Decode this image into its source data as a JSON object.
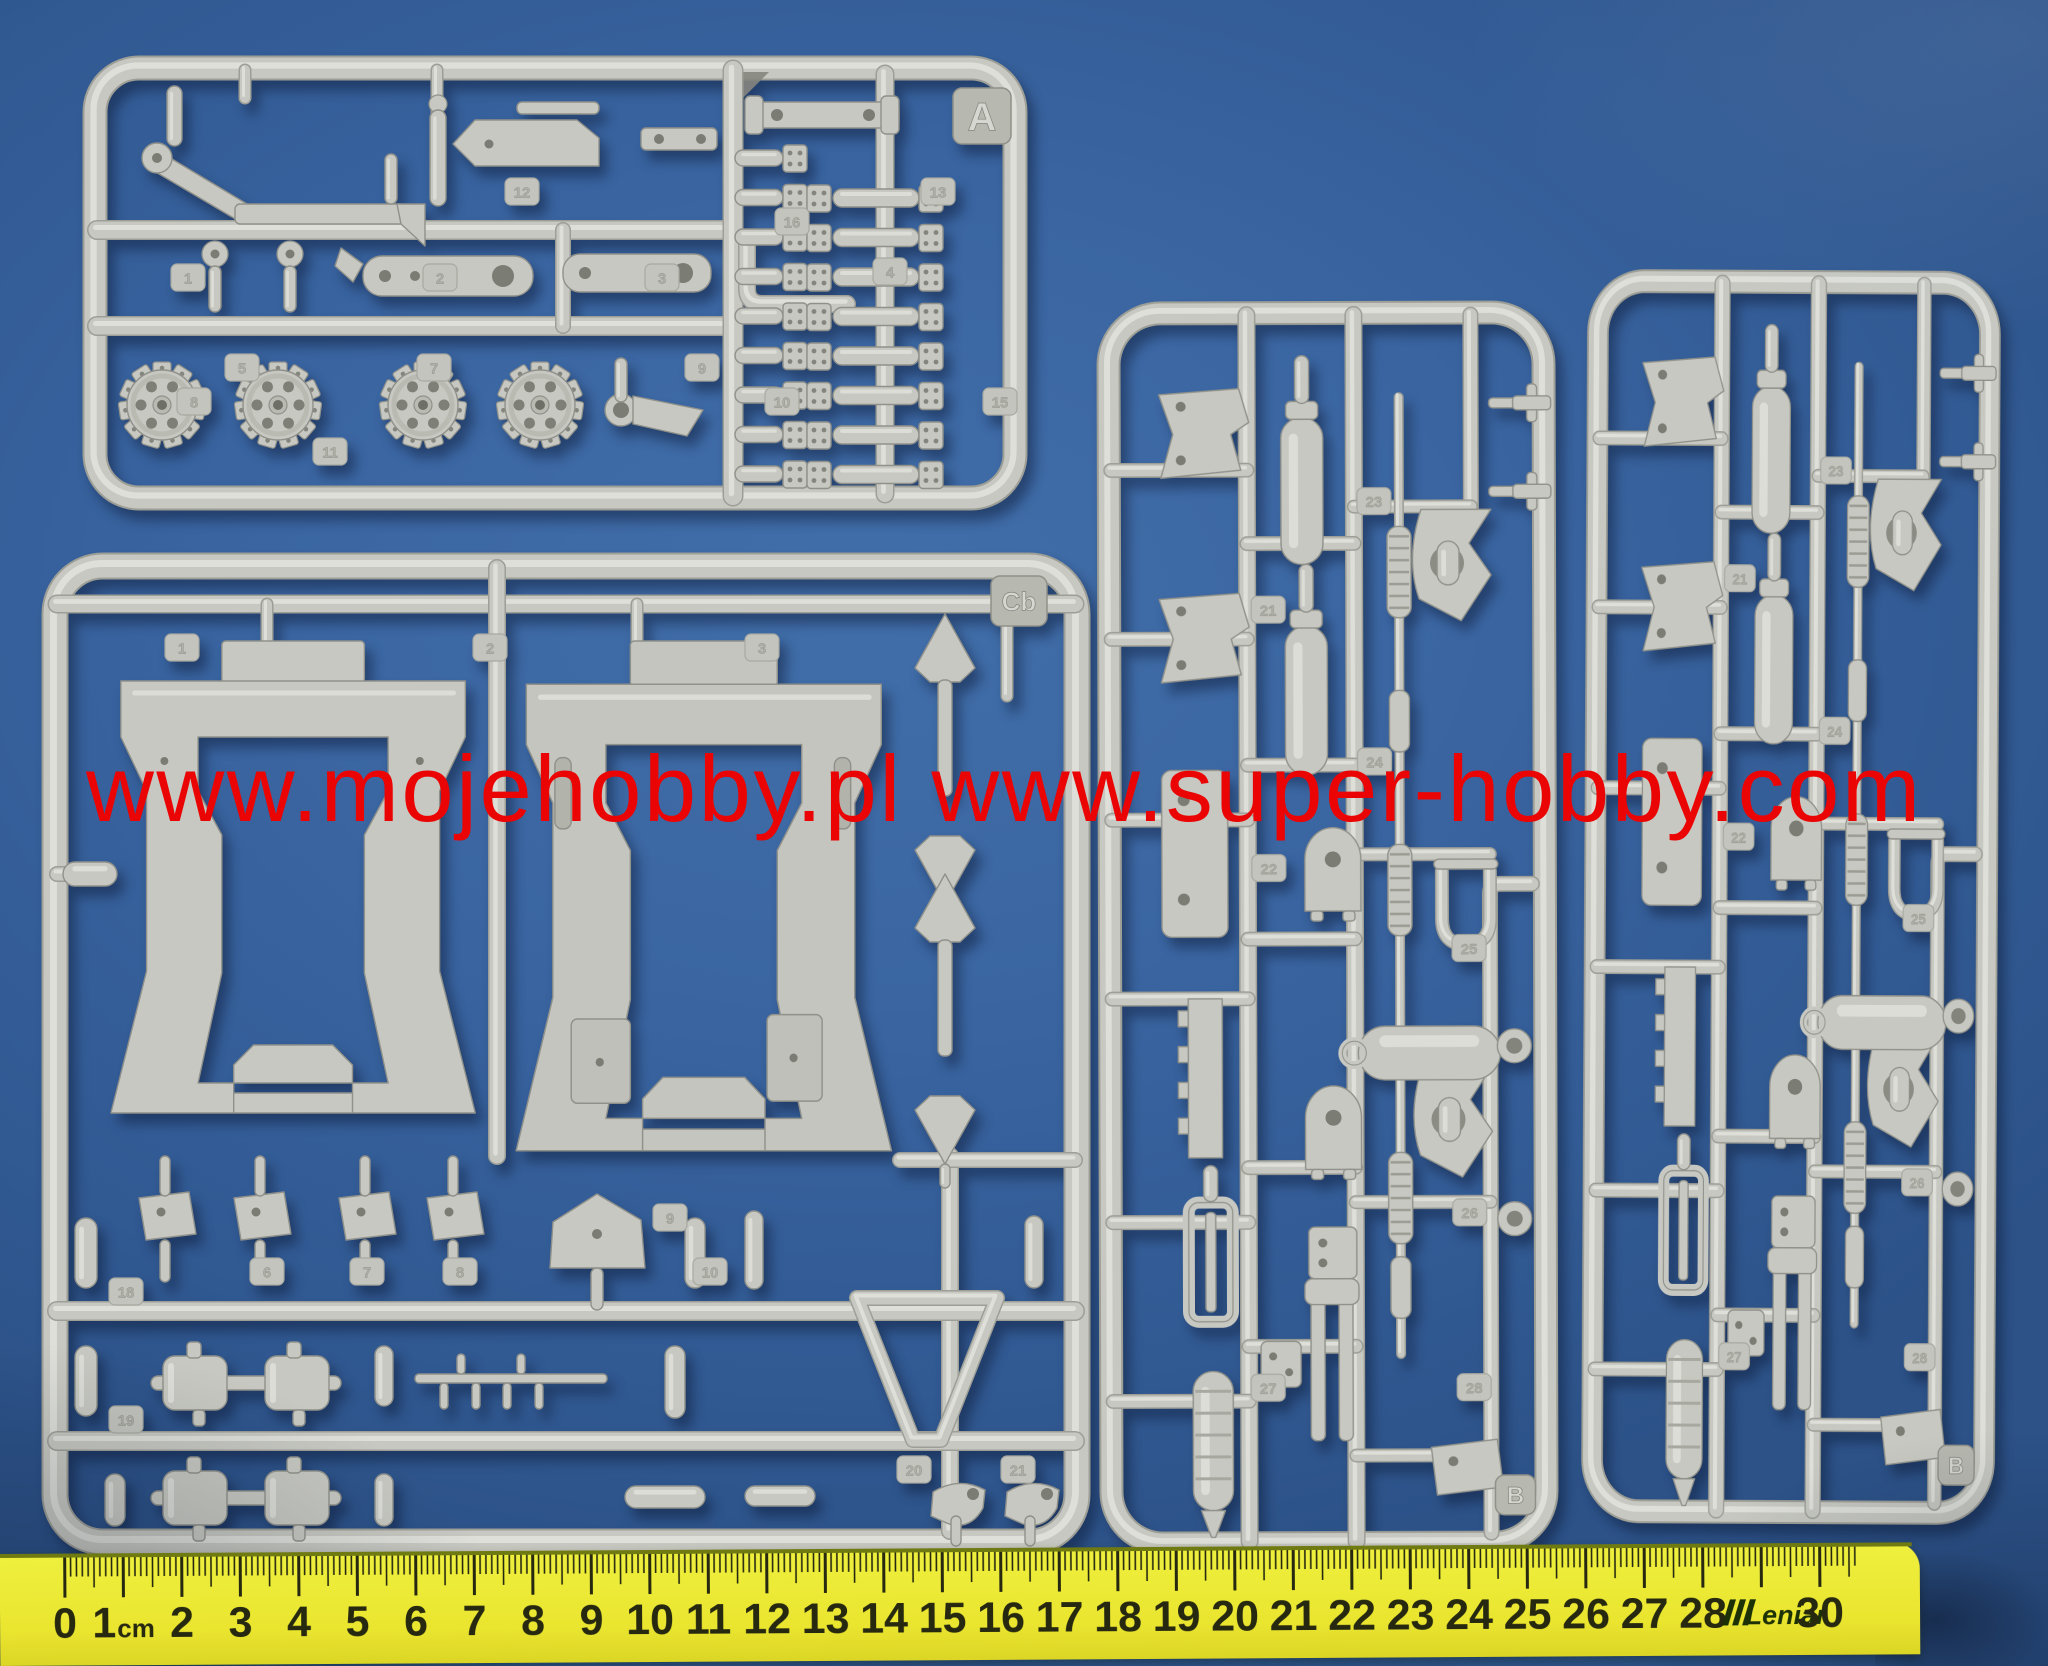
{
  "background": {
    "table_color": "#38639f"
  },
  "watermark": {
    "text": "www.mojehobby.pl www.super-hobby.com",
    "color": "#ea0404"
  },
  "sprues": {
    "plastic_color": "#c7c8c1",
    "top_left": {
      "tag": "A",
      "part_tags": [
        "1",
        "2",
        "3",
        "4",
        "5",
        "7",
        "8",
        "9",
        "10",
        "11",
        "12",
        "13",
        "15",
        "16"
      ]
    },
    "bottom_left": {
      "tag": "Cb",
      "part_tags": [
        "1",
        "2",
        "3",
        "6",
        "7",
        "8",
        "9",
        "10",
        "18",
        "19",
        "20",
        "21"
      ]
    },
    "middle": {
      "tag": "B",
      "part_tags": [
        "21",
        "22",
        "23",
        "24",
        "25",
        "26",
        "27",
        "28"
      ]
    },
    "right": {
      "tag": "B",
      "part_tags": [
        "21",
        "22",
        "23",
        "24",
        "25",
        "26",
        "27",
        "28"
      ]
    }
  },
  "ruler": {
    "brand": "Leniar",
    "labels": [
      "0",
      "1cm",
      "2",
      "3",
      "4",
      "5",
      "6",
      "7",
      "8",
      "9",
      "10",
      "11",
      "12",
      "13",
      "14",
      "15",
      "16",
      "17",
      "18",
      "19",
      "20",
      "21",
      "22",
      "23",
      "24",
      "25",
      "26",
      "27",
      "28",
      "",
      "30"
    ],
    "body_color": "#eae52f",
    "marking_color": "#26280f",
    "brand_color": "#1c3106"
  }
}
